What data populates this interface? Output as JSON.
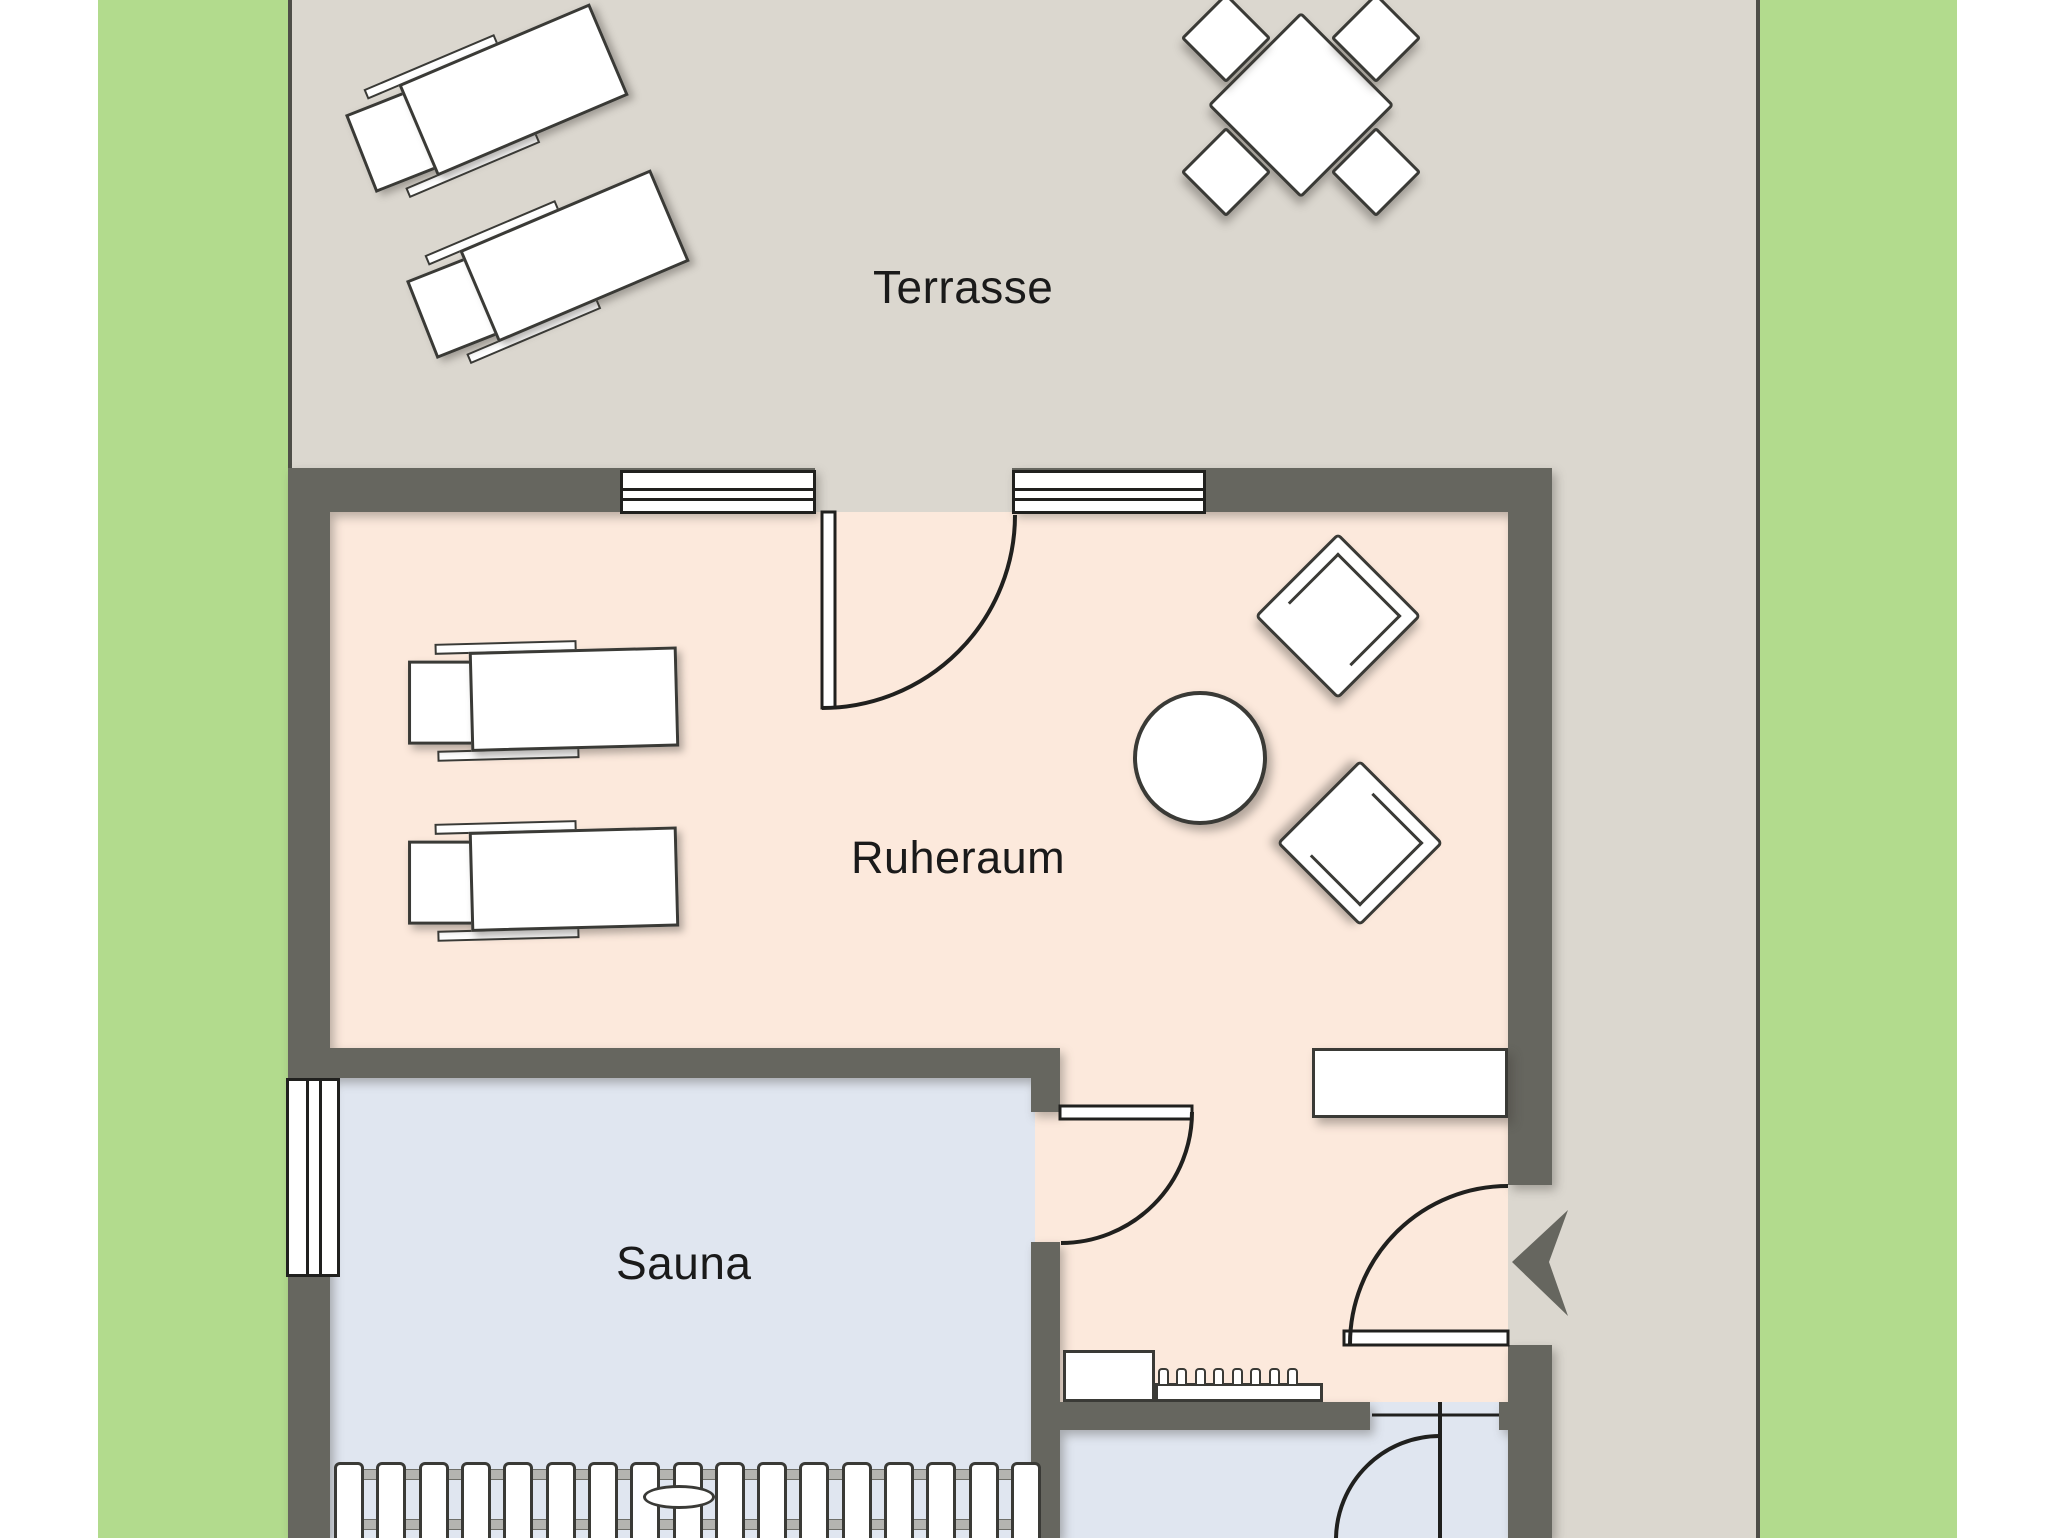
{
  "floorplan": {
    "rooms": {
      "terrace_label": "Terrasse",
      "relax_room_label": "Ruheraum",
      "sauna_label": "Sauna"
    },
    "colors": {
      "grass": "#b2db8d",
      "terrace_floor": "#dbd7cf",
      "wall": "#66665f",
      "relax_floor": "#fce9dc",
      "wet_floor": "#e0e6f0",
      "outline": "#4e4e48",
      "furniture_stroke": "#3a3a36",
      "door_stroke": "#20201e",
      "label_text": "#1a1a1a",
      "page_bg": "#ffffff"
    },
    "furniture": [
      "sun-lounger",
      "sun-lounger",
      "dining-table",
      "dining-chair",
      "dining-chair",
      "dining-chair",
      "dining-chair",
      "relax-lounger",
      "relax-lounger",
      "armchair",
      "armchair",
      "round-table",
      "side-table",
      "wall-counter",
      "radiator",
      "sauna-bench",
      "bench-handle"
    ],
    "doors": [
      "terrace-door",
      "sauna-door",
      "entrance-door",
      "back-room-door"
    ],
    "windows": [
      "top-window-left",
      "top-window-right",
      "sauna-window"
    ]
  }
}
